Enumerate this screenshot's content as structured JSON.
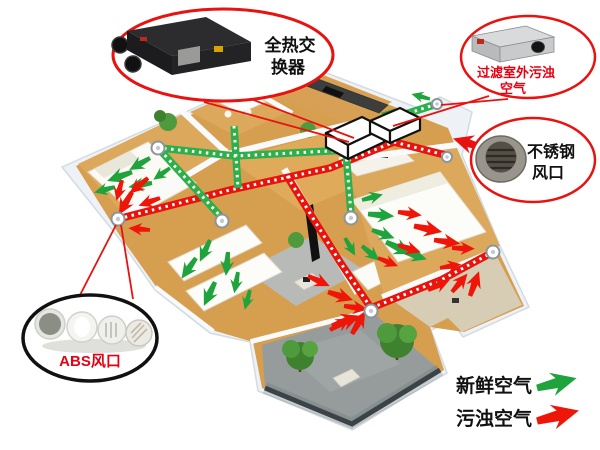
{
  "callouts": {
    "heat_exchanger": {
      "line1": "全热交",
      "line2": "换器"
    },
    "filter": {
      "line1": "过滤室外污浊",
      "line2": "空气"
    },
    "steel_vent": {
      "line1": "不锈钢",
      "line2": "风口"
    },
    "abs_vent": {
      "label": "ABS风口"
    }
  },
  "legend": {
    "fresh": "新鲜空气",
    "polluted": "污浊空气"
  },
  "colors": {
    "callout_red": "#e81310",
    "label_red": "#e60012",
    "label_black": "#111111",
    "fresh_green": "#1fa33c",
    "exhaust_red": "#ee1509",
    "duct_green": "#2db04a",
    "duct_red": "#e8130c",
    "abs_outline": "#111111"
  }
}
